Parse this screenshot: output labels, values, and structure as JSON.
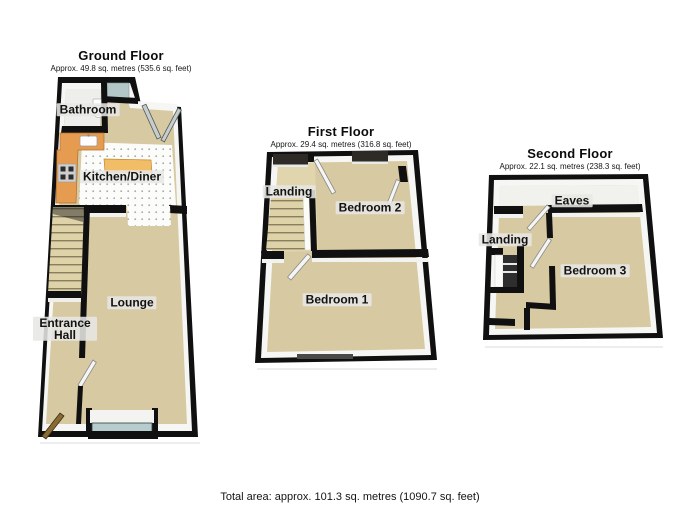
{
  "page": {
    "footer_text": "Total area: approx. 101.3 sq. metres (1090.7 sq. feet)"
  },
  "floors": [
    {
      "title": "Ground Floor",
      "subtitle": "Approx. 49.8 sq. metres (535.6 sq. feet)",
      "rooms": [
        {
          "label": "Bathroom"
        },
        {
          "label": "Kitchen/Diner"
        },
        {
          "label": "Lounge"
        },
        {
          "label": "Entrance Hall"
        }
      ]
    },
    {
      "title": "First Floor",
      "subtitle": "Approx. 29.4 sq. metres (316.8 sq. feet)",
      "rooms": [
        {
          "label": "Landing"
        },
        {
          "label": "Bedroom 2"
        },
        {
          "label": "Bedroom 1"
        }
      ]
    },
    {
      "title": "Second Floor",
      "subtitle": "Approx. 22.1 sq. metres (238.3 sq. feet)",
      "rooms": [
        {
          "label": "Eaves"
        },
        {
          "label": "Landing"
        },
        {
          "label": "Bedroom 3"
        }
      ]
    }
  ],
  "colors": {
    "wall": "#101010",
    "floor_tan": "#d7c9a2",
    "landing_tan": "#e0d5ac",
    "bathroom_floor": "#eeeeec",
    "eaves_floor": "#f1f1ee",
    "kitchen_counter": "#e59c50",
    "kitchen_island": "#f1bd66",
    "window_glass_light": "#b3c6c8",
    "window_glass_bay": "#b7cdcd",
    "window_dark": "#2e2a26",
    "stairwell_dark": "#2e2e2e",
    "front_door": "#8a6a33"
  }
}
